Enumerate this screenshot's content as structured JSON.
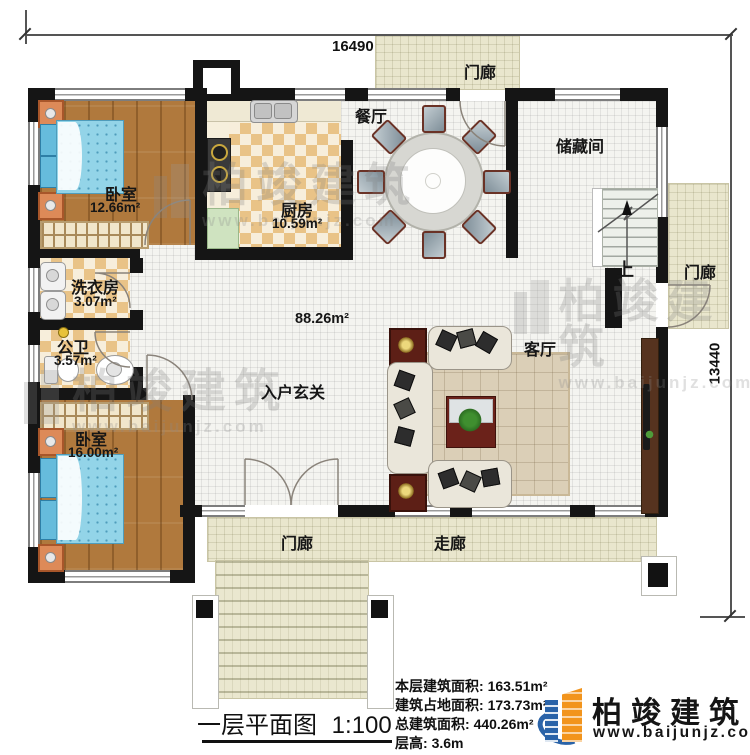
{
  "dimensions": {
    "width": "16490",
    "height": "13440"
  },
  "rooms": {
    "bedroom1": {
      "name": "卧室",
      "area": "12.66m²"
    },
    "kitchen": {
      "name": "厨房",
      "area": "10.59m²"
    },
    "dining": {
      "name": "餐厅"
    },
    "porch_top": {
      "name": "门廊"
    },
    "storage": {
      "name": "储藏间"
    },
    "porch_right": {
      "name": "门廊"
    },
    "laundry": {
      "name": "洗衣房",
      "area": "3.07m²"
    },
    "bathroom": {
      "name": "公卫",
      "area": "3.57m²"
    },
    "bedroom2": {
      "name": "卧室",
      "area": "16.00m²"
    },
    "foyer": {
      "name": "入户玄关"
    },
    "hall": {
      "area": "88.26m²"
    },
    "living": {
      "name": "客厅"
    },
    "stairs": {
      "up_label": "上"
    },
    "porch_bottom": {
      "name": "门廊"
    },
    "corridor": {
      "name": "走廊"
    }
  },
  "title": {
    "name": "一层平面图",
    "scale": "1:100"
  },
  "stats": [
    {
      "label": "本层建筑面积:",
      "value": "163.51m²"
    },
    {
      "label": "建筑占地面积:",
      "value": "173.73m²"
    },
    {
      "label": "总建筑面积:",
      "value": "440.26m²"
    },
    {
      "label": "层高:",
      "value": "3.6m"
    }
  ],
  "brand": {
    "name": "柏竣建筑",
    "website": "www.baijunjz.com"
  },
  "colors": {
    "wall": "#151515",
    "wood_floor": "#b0793d",
    "checker_tile": "#e9c387",
    "porch_floor": "#e9e6cd",
    "bed": "#93d4e8",
    "logo_orange": "#f2941c",
    "logo_blue": "#2a63a8"
  }
}
